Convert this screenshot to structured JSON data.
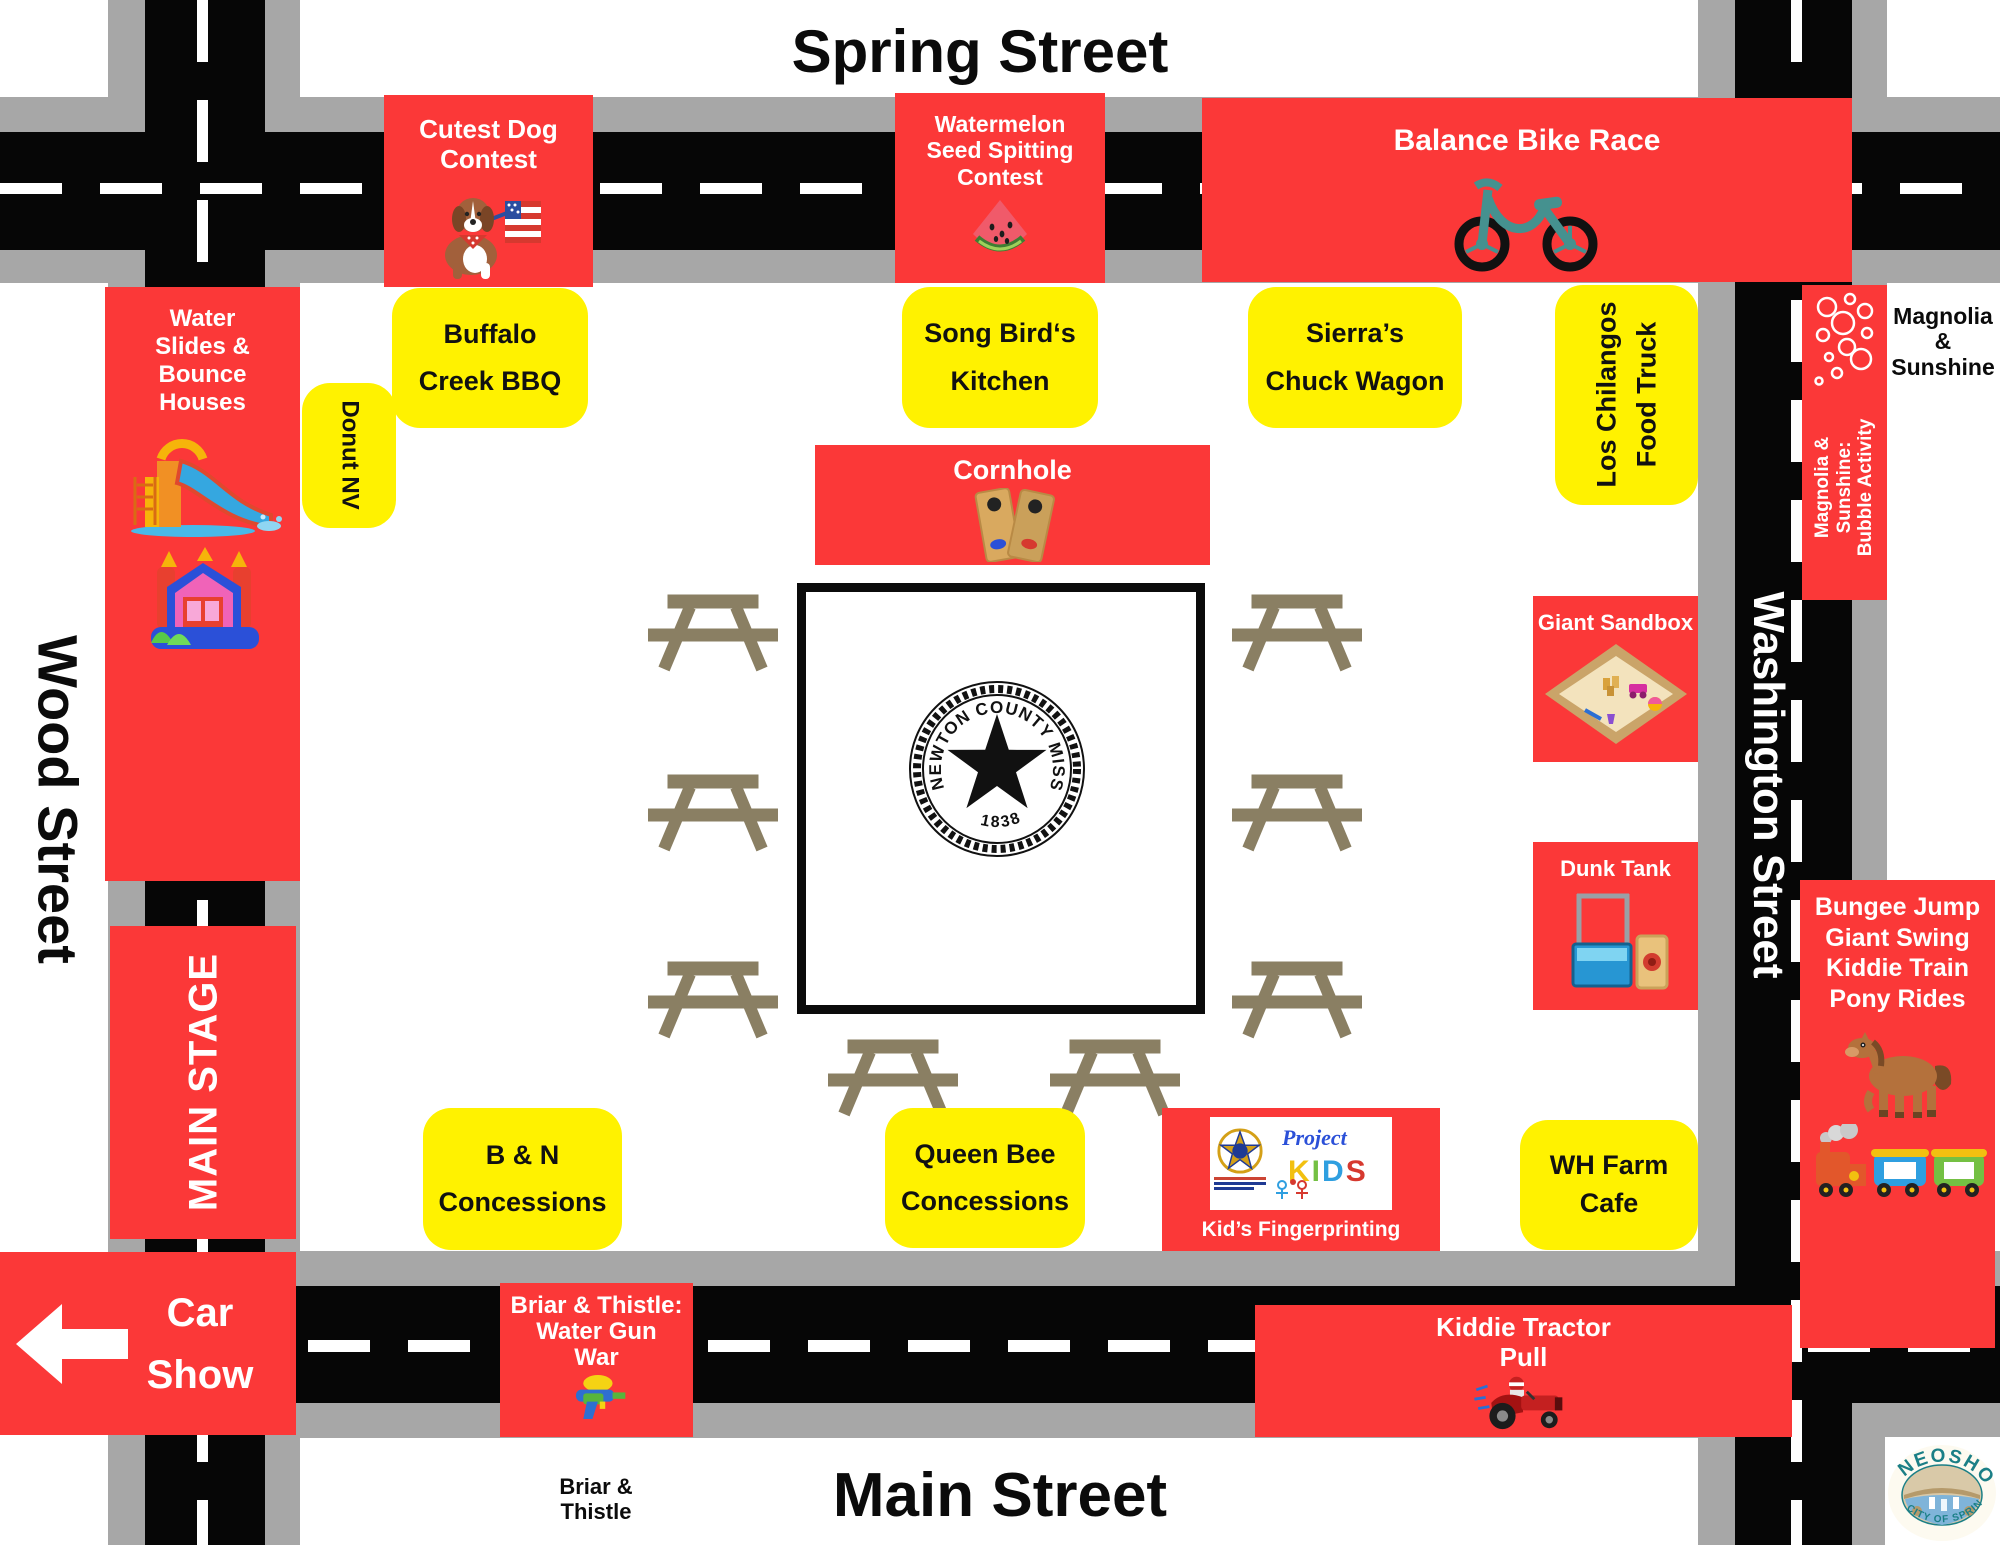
{
  "streets": {
    "top": "Spring Street",
    "left": "Wood Street",
    "right": "Washington Street",
    "bottom": "Main Street"
  },
  "activities": {
    "cutest_dog": "Cutest Dog\nContest",
    "watermelon": "Watermelon\nSeed Spitting\nContest",
    "bike_race": "Balance Bike Race",
    "cornhole": "Cornhole",
    "water_slides": "Water\nSlides &\nBounce\nHouses",
    "main_stage": "MAIN STAGE",
    "car_show": "Car\nShow",
    "bubble_activity": "Magnolia &\nSunshine:\nBubble Activity",
    "magnolia_note": "Magnolia\n&\nSunshine",
    "giant_sandbox": "Giant Sandbox",
    "dunk_tank": "Dunk Tank",
    "bungee": "Bungee Jump\nGiant Swing\nKiddie Train\nPony Rides",
    "kids_fingerprinting": "Kid’s Fingerprinting",
    "tractor_pull": "Kiddie Tractor\nPull",
    "water_gun_war": "Briar & Thistle:\nWater Gun\nWar",
    "briar_note": "Briar &\nThistle"
  },
  "vendors": {
    "buffalo": "Buffalo\nCreek BBQ",
    "songbird": "Song Bird‘s\nKitchen",
    "sierras": "Sierra’s\nChuck Wagon",
    "chilangos": "Los Chilangos\nFood Truck",
    "donut": "Donut NV",
    "bn": "B & N\nConcessions",
    "queenbee": "Queen Bee\nConcessions",
    "whfarm": "WH Farm\nCafe"
  },
  "seal": {
    "text": "NEWTON COUNTY MISSOURI",
    "year": "1838"
  },
  "project_kids": {
    "project": "Project",
    "kids": "KIDS"
  },
  "neosho": {
    "name": "NEOSHO",
    "tagline": "CITY OF SPRINGS"
  },
  "colors": {
    "booth_red": "#fb3838",
    "booth_yellow": "#fff200",
    "road": "#060606",
    "sidewalk": "#a7a7a7",
    "picnic_table": "#8a7f63",
    "bike_teal": "#45918f"
  }
}
